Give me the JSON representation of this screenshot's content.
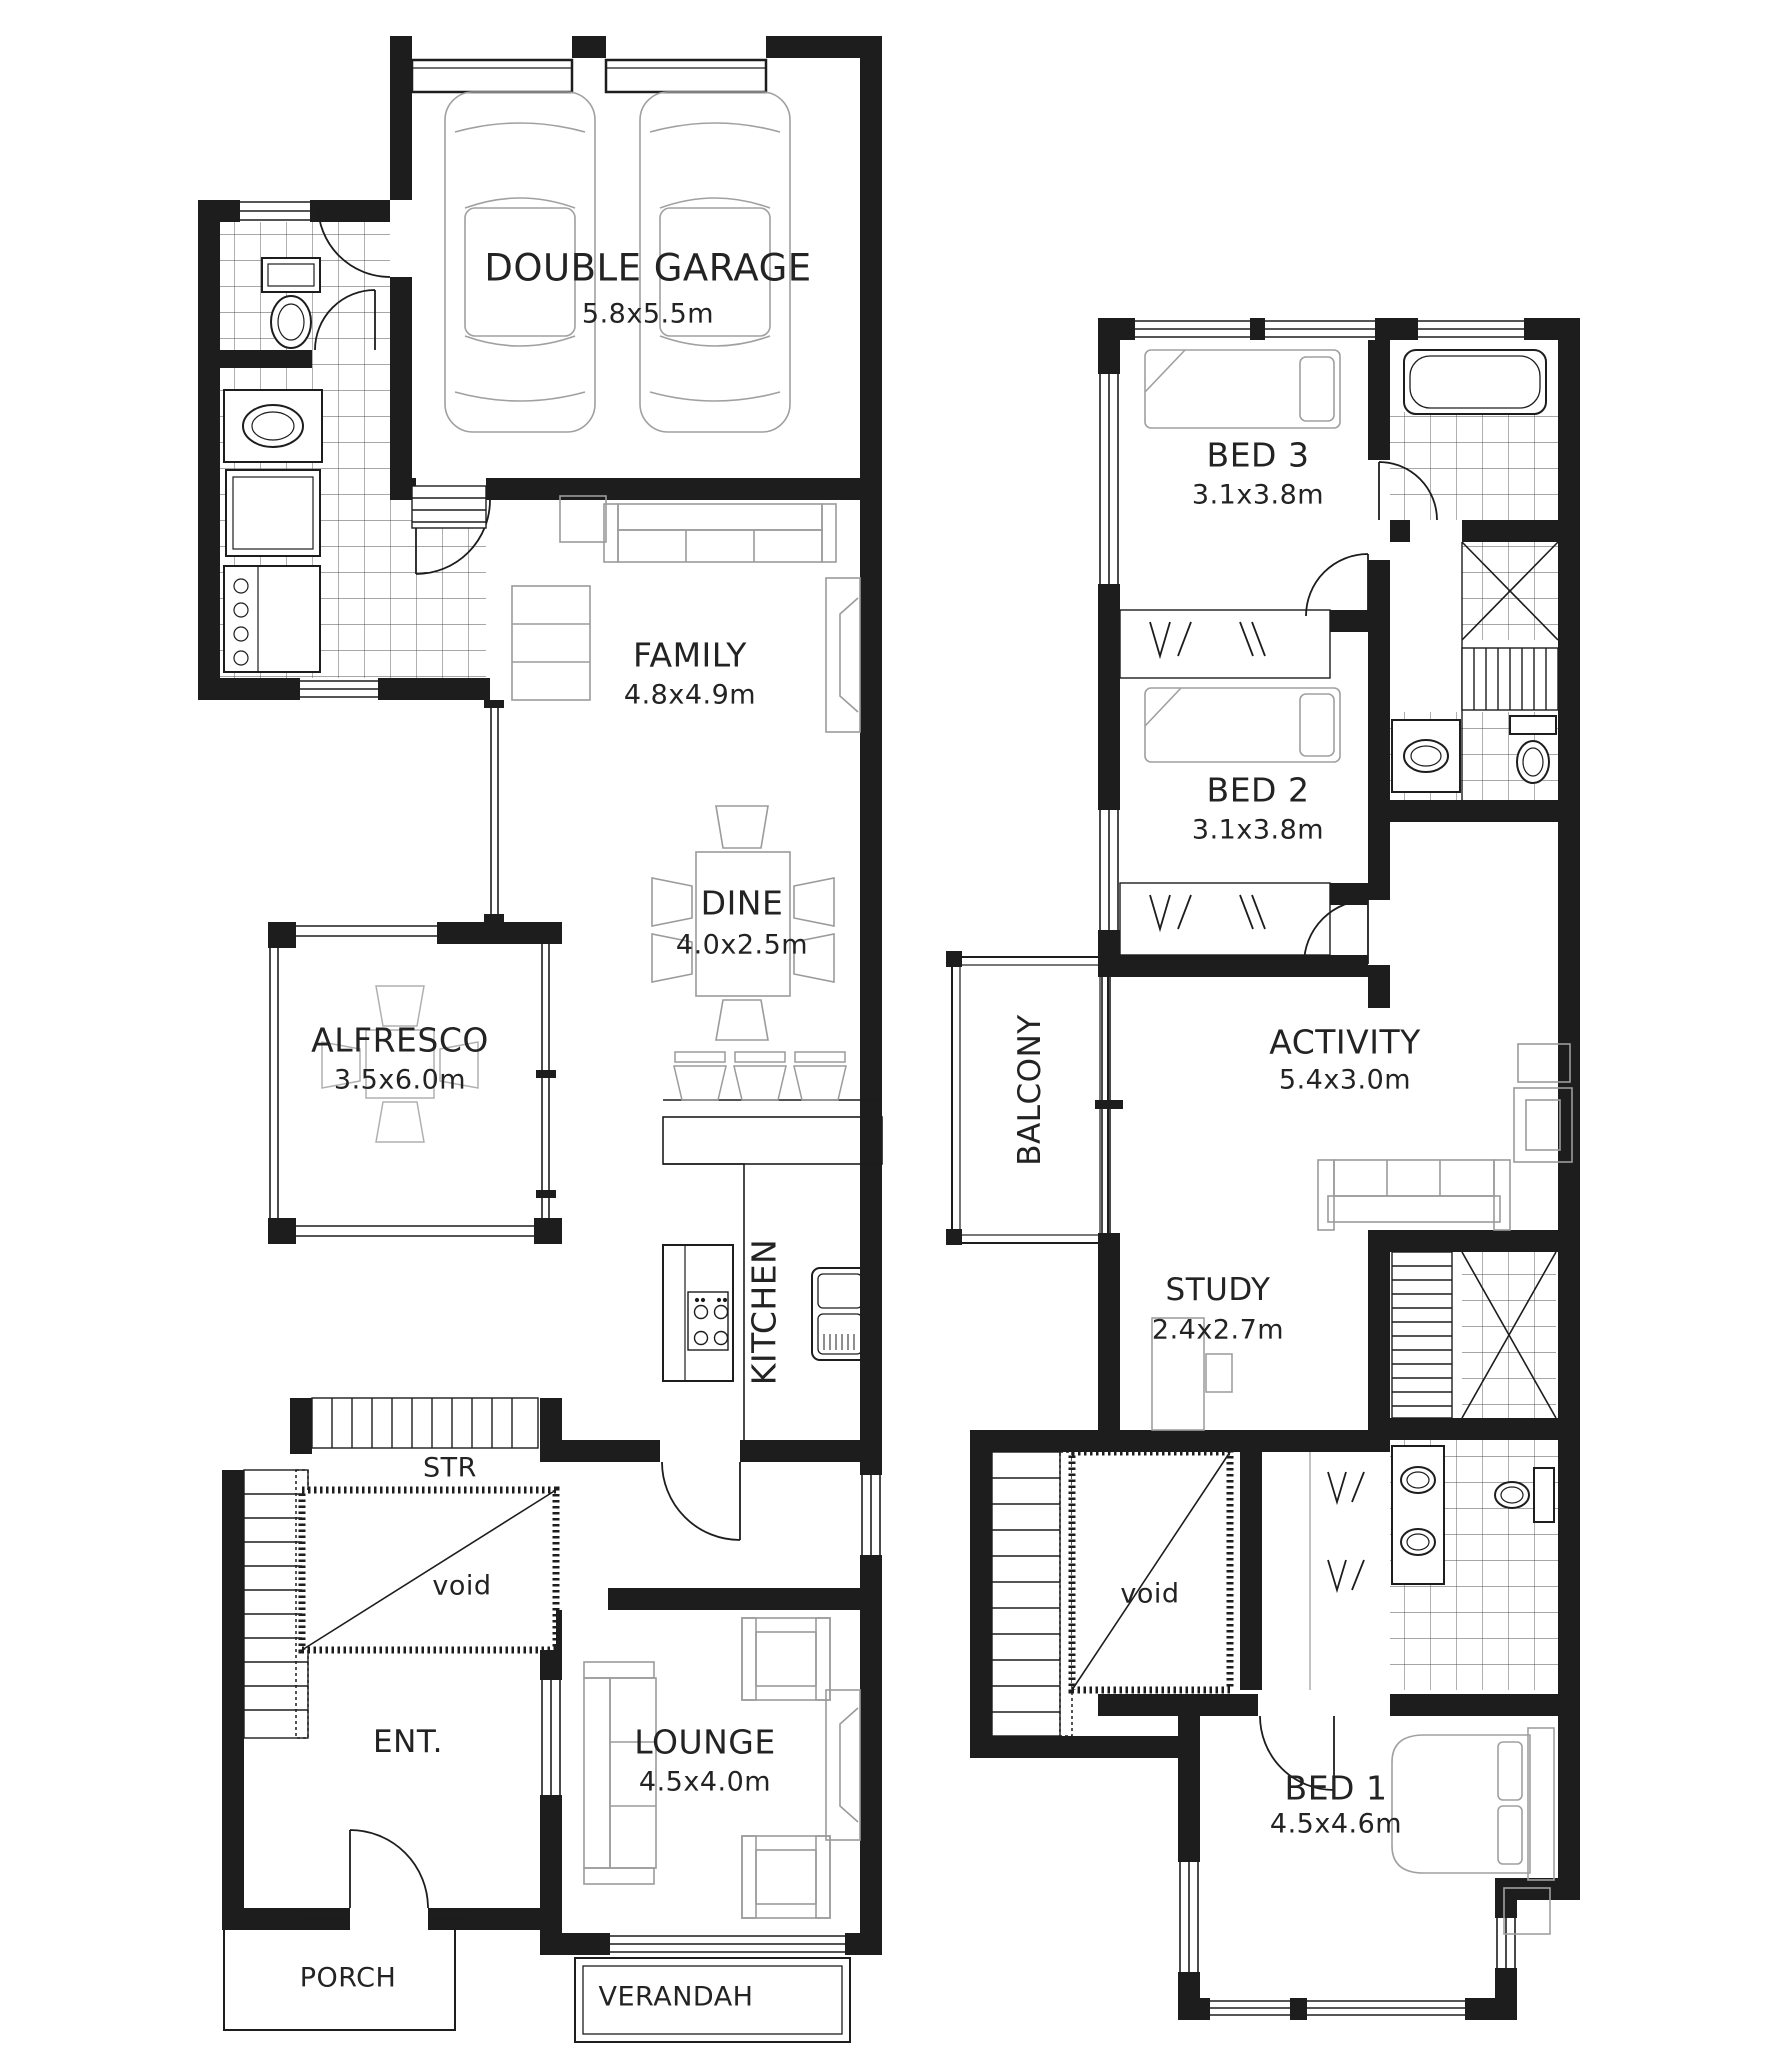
{
  "document": {
    "type": "architectural floor plan",
    "storeys": 2
  },
  "ground_floor": {
    "garage": {
      "name": "DOUBLE GARAGE",
      "dims": "5.8x5.5m"
    },
    "family": {
      "name": "FAMILY",
      "dims": "4.8x4.9m"
    },
    "dine": {
      "name": "DINE",
      "dims": "4.0x2.5m"
    },
    "alfresco": {
      "name": "ALFRESCO",
      "dims": "3.5x6.0m"
    },
    "kitchen": {
      "name": "KITCHEN"
    },
    "stairs": {
      "name": "STR"
    },
    "void": {
      "name": "void"
    },
    "entry": {
      "name": "ENT."
    },
    "lounge": {
      "name": "LOUNGE",
      "dims": "4.5x4.0m"
    },
    "porch": {
      "name": "PORCH"
    },
    "verandah": {
      "name": "VERANDAH"
    }
  },
  "upper_floor": {
    "bed3": {
      "name": "BED 3",
      "dims": "3.1x3.8m"
    },
    "bed2": {
      "name": "BED 2",
      "dims": "3.1x3.8m"
    },
    "balcony": {
      "name": "BALCONY"
    },
    "activity": {
      "name": "ACTIVITY",
      "dims": "5.4x3.0m"
    },
    "study": {
      "name": "STUDY",
      "dims": "2.4x2.7m"
    },
    "void": {
      "name": "void"
    },
    "bed1": {
      "name": "BED 1",
      "dims": "4.5x4.6m"
    }
  },
  "colors": {
    "wall": "#1d1d1d",
    "furniture_outline": "#a0a0a0",
    "tile_line": "#4f4f4f",
    "background": "#ffffff",
    "text": "#232323"
  }
}
